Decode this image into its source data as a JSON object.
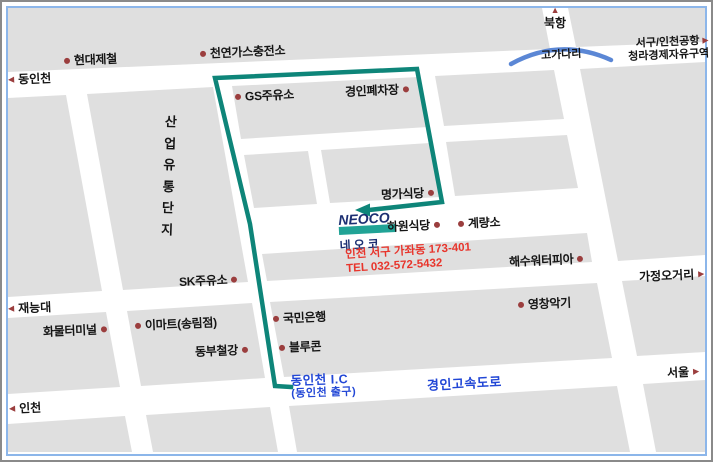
{
  "logo": {
    "name": "NEOCO",
    "korean": "네오코"
  },
  "address": {
    "line1": "인천 서구 가좌동 173-401",
    "line2": "TEL 032-572-5432"
  },
  "pois": [
    {
      "id": "hyundai-steel",
      "text": "현대제철",
      "dot": "left",
      "x": 64,
      "y": 52
    },
    {
      "id": "cng-charging-station",
      "text": "천연가스충전소",
      "dot": "left",
      "x": 200,
      "y": 45
    },
    {
      "id": "gs-gas-station",
      "text": "GS주유소",
      "dot": "left",
      "x": 235,
      "y": 88
    },
    {
      "id": "gyeongin-scrapyard",
      "text": "경인폐차장",
      "dot": "right",
      "x": 345,
      "y": 83
    },
    {
      "id": "myeongga-restaurant",
      "text": "명가식당",
      "dot": "right",
      "x": 381,
      "y": 186
    },
    {
      "id": "hawon-restaurant",
      "text": "하원식당",
      "dot": "right",
      "x": 387,
      "y": 218
    },
    {
      "id": "gyeryangso",
      "text": "계량소",
      "dot": "left",
      "x": 458,
      "y": 215
    },
    {
      "id": "haesu-waterpia",
      "text": "해수워터피아",
      "dot": "right",
      "x": 509,
      "y": 253
    },
    {
      "id": "sk-gas-station",
      "text": "SK주유소",
      "dot": "right",
      "x": 179,
      "y": 273
    },
    {
      "id": "cargo-terminal",
      "text": "화물터미널",
      "dot": "right",
      "x": 43,
      "y": 323
    },
    {
      "id": "emart-songnim",
      "text": "이마트(송림점)",
      "dot": "left",
      "x": 135,
      "y": 317
    },
    {
      "id": "dongbu-steel",
      "text": "동부철강",
      "dot": "right",
      "x": 195,
      "y": 343
    },
    {
      "id": "kookmin-bank",
      "text": "국민은행",
      "dot": "left",
      "x": 273,
      "y": 310
    },
    {
      "id": "bluecon",
      "text": "블루콘",
      "dot": "left",
      "x": 279,
      "y": 339
    },
    {
      "id": "youngchang-music",
      "text": "영창악기",
      "dot": "left",
      "x": 518,
      "y": 296
    }
  ],
  "directions": [
    {
      "id": "dongincheon",
      "text": "동인천",
      "arrow": "left",
      "x": 8,
      "y": 71
    },
    {
      "id": "bukhang",
      "text": "북항",
      "arrow": "up",
      "x": 544,
      "y": 6
    },
    {
      "id": "seogu-incheon-airport",
      "lines": [
        "서구/인천공항",
        "청라경제자유구역"
      ],
      "arrow": "right",
      "x": 628,
      "y": 38
    },
    {
      "id": "jaeneung-univ",
      "text": "재능대",
      "arrow": "left",
      "x": 8,
      "y": 300
    },
    {
      "id": "gajeong-ogeori",
      "text": "가정오거리",
      "arrow": "right",
      "x": 639,
      "y": 268
    },
    {
      "id": "seoul",
      "text": "서울",
      "arrow": "right",
      "x": 667,
      "y": 364
    },
    {
      "id": "incheon",
      "text": "인천",
      "arrow": "left",
      "x": 9,
      "y": 400
    }
  ],
  "roads": [
    {
      "id": "gogadari-overpass",
      "text": "고가다리",
      "cls": "black",
      "x": 541,
      "y": 47
    },
    {
      "id": "industrial-distribution-complex",
      "text": "산업유통단지",
      "cls": "vert",
      "x": 163,
      "y": 111
    },
    {
      "id": "gyeongin-expressway",
      "text": "경인고속도로",
      "cls": "blue",
      "x": 427,
      "y": 375
    },
    {
      "id": "dongincheon-ic",
      "lines": [
        "동인천 I.C",
        "(동인천 출구)"
      ],
      "cls": "blue ic",
      "x": 291,
      "y": 375
    }
  ],
  "colors": {
    "route": "#0e8579",
    "marker": "#9b3e3e",
    "poi_text": "#151515",
    "blue_road_text": "#2247d6",
    "address_text": "#e8352c",
    "bridge": "#5b87d5",
    "block_fill": "#dfdfdf",
    "road_fill": "#ffffff",
    "map_border": "#8cb6ea",
    "frame_border": "#8a8a8a",
    "logo_navy": "#1c2f72",
    "logo_teal": "#21a396"
  }
}
